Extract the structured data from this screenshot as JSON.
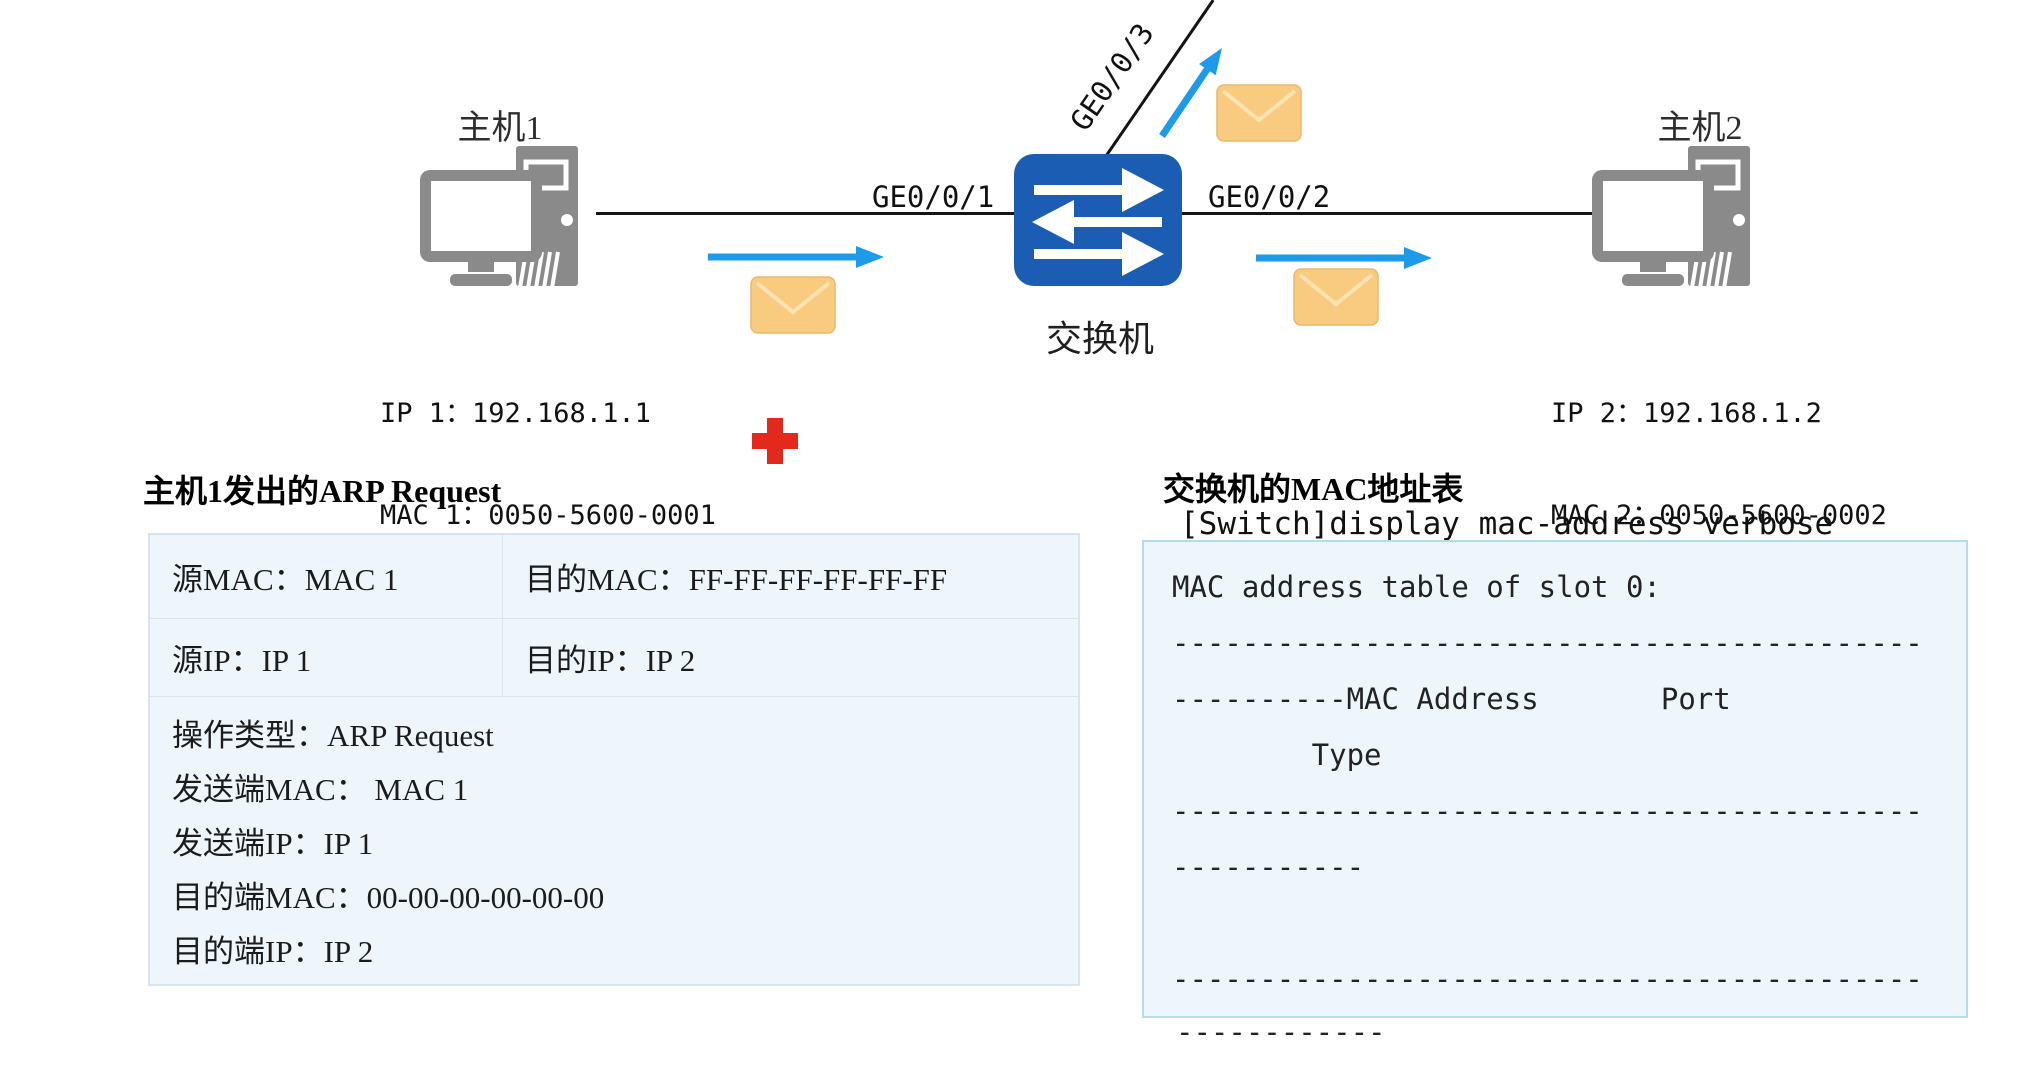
{
  "topology": {
    "host1": {
      "label": "主机1",
      "ip_line": "IP 1：192.168.1.1",
      "mac_line": "MAC 1：0050-5600-0001"
    },
    "host2": {
      "label": "主机2",
      "ip_line": "IP 2：192.168.1.2",
      "mac_line": "MAC 2：0050-5600-0002"
    },
    "switch": {
      "label": "交换机"
    },
    "ports": {
      "ge1": "GE0/0/1",
      "ge2": "GE0/0/2",
      "ge3": "GE0/0/3"
    },
    "icons": {
      "host": "desktop-computer-icon",
      "switch": "switch-arrows-icon",
      "packet": "envelope-icon",
      "drop": "red-cross-icon",
      "flow": "blue-arrow-icon"
    }
  },
  "arp_panel": {
    "title": "主机1发出的ARP Request",
    "row1": {
      "src_mac": "源MAC：MAC 1",
      "dst_mac": "目的MAC：FF-FF-FF-FF-FF-FF"
    },
    "row2": {
      "src_ip": "源IP：IP 1",
      "dst_ip": "目的IP：IP 2"
    },
    "detail_lines": [
      "操作类型：ARP Request",
      "发送端MAC： MAC 1",
      "发送端IP：IP 1",
      "目的端MAC：00-00-00-00-00-00",
      "目的端IP：IP 2"
    ]
  },
  "mac_panel": {
    "title": "交换机的MAC地址表",
    "command": "[Switch]display mac-address verbose",
    "output_lines": [
      "MAC address table of slot 0:",
      "-------------------------------------------",
      "----------MAC Address       Port",
      "        Type",
      "-------------------------------------------",
      "-----------",
      "",
      "-------------------------------------------"
    ],
    "below_box": "------------"
  },
  "colors": {
    "switch_blue": "#1a5db3",
    "device_gray": "#8a8a8a",
    "arrow_blue": "#1e9be8",
    "envelope_fill": "#f8cb81",
    "envelope_edge": "#eab96b",
    "envelope_flap": "#fbe3b2",
    "cross_red": "#e3281c",
    "panel_fill": "#eef6fb",
    "panel_border": "#d6e5ef",
    "box_fill": "#edf7fb",
    "box_border": "#b3dcec",
    "line_black": "#141414"
  }
}
